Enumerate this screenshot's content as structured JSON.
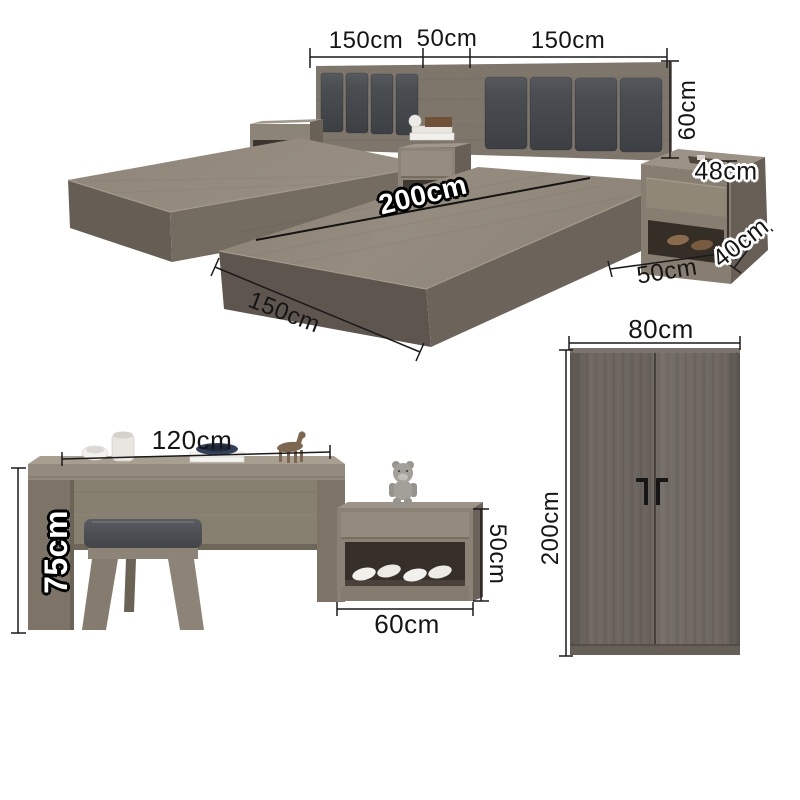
{
  "bed_section": {
    "headboard_left_width": "150cm",
    "headboard_gap_width": "50cm",
    "headboard_right_width": "150cm",
    "headboard_height": "60cm",
    "bed_length": "200cm",
    "bed_width": "150cm",
    "nightstand_height": "48cm",
    "nightstand_width": "50cm",
    "nightstand_depth": "40cm"
  },
  "desk_section": {
    "desk_width": "120cm",
    "desk_height": "75cm",
    "shoe_cabinet_height": "50cm",
    "shoe_cabinet_width": "60cm"
  },
  "wardrobe_section": {
    "wardrobe_width": "80cm",
    "wardrobe_height": "200cm"
  },
  "colors": {
    "background": "#ffffff",
    "wood_light": "#968d80",
    "wood_medium": "#877e71",
    "wood_dark": "#665e55",
    "cushion_dark": "#45494e",
    "dimension_line": "#1a1a1a",
    "label_text": "#151515"
  }
}
